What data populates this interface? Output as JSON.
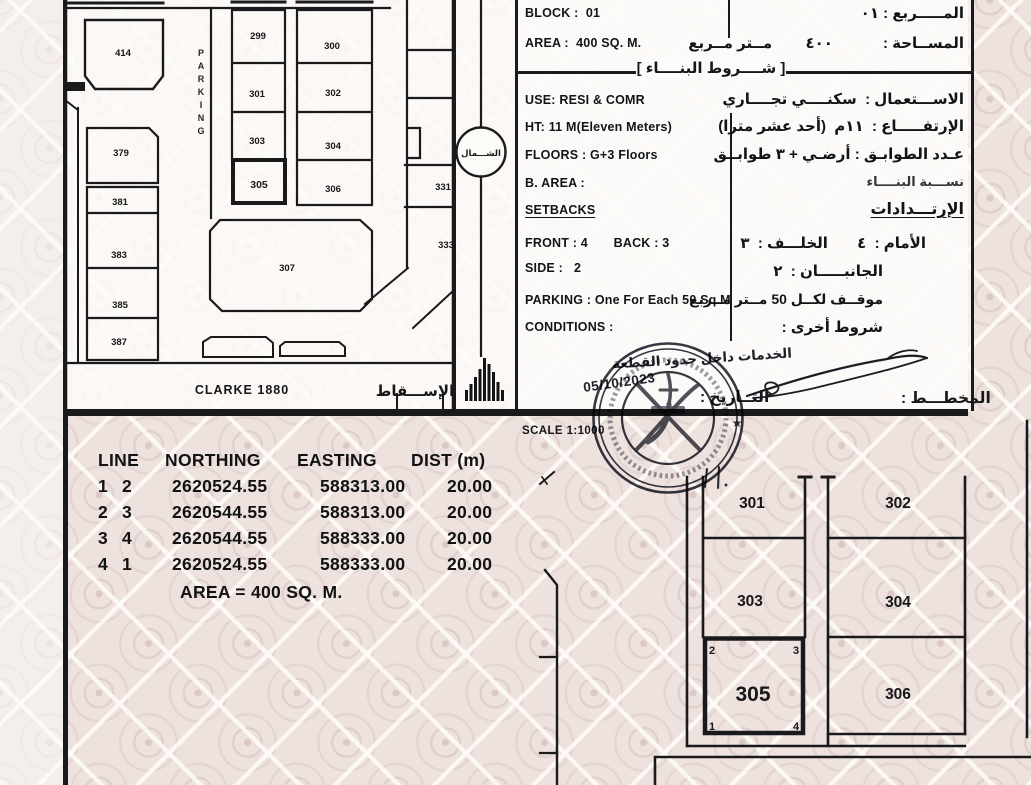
{
  "misc": {
    "scale_label": "SCALE 1:1000",
    "date_value": "05/10/2023",
    "date_label_ar": "التــاريخ :",
    "plan_label_ar": "المخطـــط :",
    "services_note_ar": "الخدمات داخل حدود القطعة",
    "star": "★"
  },
  "top_map": {
    "parking_vertical": "PARKING",
    "north_ar": "الشـــمال",
    "projection_en": "CLARKE 1880",
    "projection_ar": "الإســـقاط",
    "plots": {
      "p414": "414",
      "p299": "299",
      "p300": "300",
      "p301": "301",
      "p302": "302",
      "p303": "303",
      "p304": "304",
      "p305": "305",
      "p306": "306",
      "p307": "307",
      "p379": "379",
      "p381": "381",
      "p383": "383",
      "p385": "385",
      "p387": "387",
      "p331": "331",
      "p333": "333"
    }
  },
  "info": {
    "block_en": "BLOCK :  01",
    "block_ar": "المـــــربع : ٠١",
    "area_en": "AREA :  400 SQ. M.",
    "area_ar": "المســاحة :            ٤٠٠        مــتر مــربع",
    "bracket_l": "[",
    "bracket_r": "]",
    "conditions_title_ar": "شــــروط البنــــاء",
    "use_en": "USE: RESI & COMR",
    "use_ar": "الاســـتعمال :  سكنــــي تجــــاري",
    "height_en": "HT: 11 M(Eleven Meters)",
    "height_ar": "الإرتفـــــاع :  ١١م  (أحد عشر مترا)",
    "floors_en": "FLOORS : G+3 Floors",
    "floors_ar": "عـدد الطوابـق : أرضـي + ٣ طوابــق",
    "barea_en": "B. AREA :",
    "barea_ar": "نســـبة البنــــاء",
    "setbacks_en": "SETBACKS",
    "setbacks_ar": "الإرتـــدادات",
    "front_back_en": "FRONT : 4       BACK : 3",
    "front_back_ar": "الأمام :  ٤       الخلـــف :  ٣",
    "side_en": "SIDE :   2",
    "side_ar": "الجانبـــــان :  ٢",
    "parking_en": "PARKING : One For Each 50 Sq.M",
    "parking_ar": "موقــف لكــل 50 مــتر مــربع",
    "conditions_en": "CONDITIONS :",
    "conditions_ar": "شروط أخرى :"
  },
  "coords_table": {
    "headers": {
      "line": "LINE",
      "northing": "NORTHING",
      "easting": "EASTING",
      "dist": "DIST (m)"
    },
    "rows": [
      {
        "a": "1",
        "b": "2",
        "northing": "2620524.55",
        "easting": "588313.00",
        "dist": "20.00"
      },
      {
        "a": "2",
        "b": "3",
        "northing": "2620544.55",
        "easting": "588313.00",
        "dist": "20.00"
      },
      {
        "a": "3",
        "b": "4",
        "northing": "2620544.55",
        "easting": "588333.00",
        "dist": "20.00"
      },
      {
        "a": "4",
        "b": "1",
        "northing": "2620524.55",
        "easting": "588333.00",
        "dist": "20.00"
      }
    ],
    "area_line": "AREA = 400 SQ. M."
  },
  "bottom_map": {
    "plots": {
      "p301": "301",
      "p302": "302",
      "p303": "303",
      "p304": "304",
      "p305": "305",
      "p306": "306"
    },
    "corners": {
      "c1": "1",
      "c2": "2",
      "c3": "3",
      "c4": "4"
    }
  }
}
